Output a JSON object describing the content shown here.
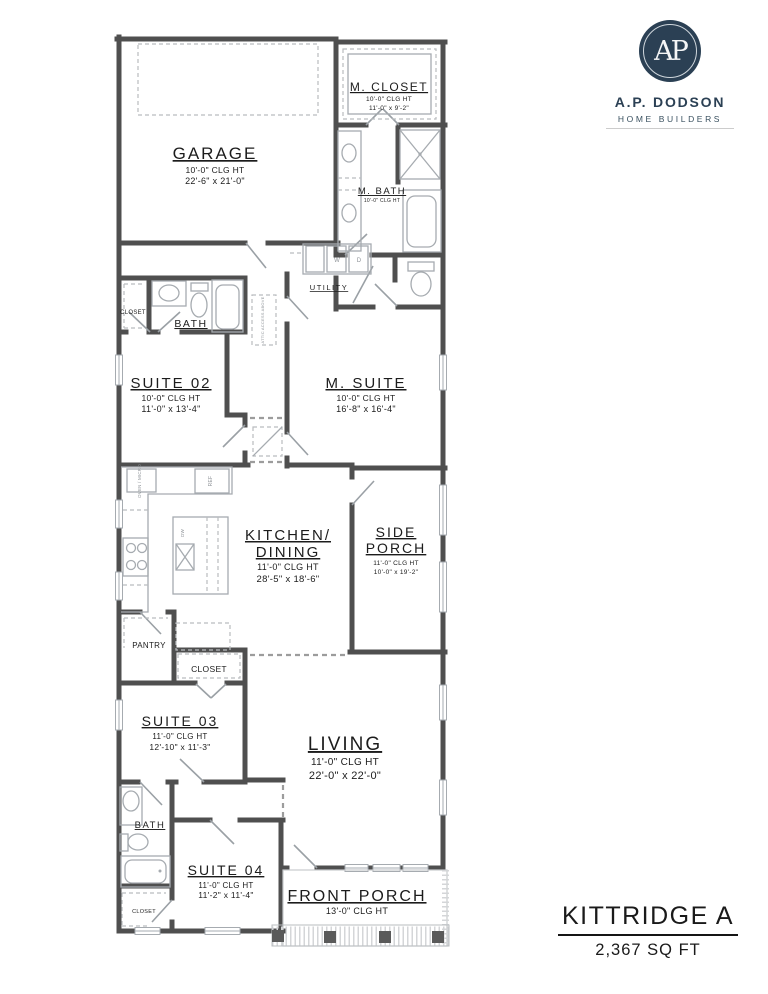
{
  "brand": {
    "monogram": "AP",
    "name": "A.P. DODSON",
    "tagline": "HOME BUILDERS",
    "navy": "#2b4054"
  },
  "title_block": {
    "plan_name": "KITTRIDGE A",
    "area": "2,367 SQ FT"
  },
  "rooms": {
    "garage": {
      "label": "GARAGE",
      "clg": "10'-0\" CLG HT",
      "dims": "22'-6\" x 21'-0\""
    },
    "m_closet": {
      "label": "M. CLOSET",
      "clg": "10'-0\" CLG HT",
      "dims": "11'-0\" x 9'-2\""
    },
    "m_bath": {
      "label": "M. BATH",
      "clg": "10'-0\" CLG HT"
    },
    "utility": {
      "label": "UTILITY"
    },
    "bath2": {
      "label": "BATH"
    },
    "closet2": {
      "label": "CLOSET"
    },
    "suite02": {
      "label": "SUITE 02",
      "clg": "10'-0\" CLG HT",
      "dims": "11'-0\" x 13'-4\""
    },
    "m_suite": {
      "label": "M. SUITE",
      "clg": "10'-0\" CLG HT",
      "dims": "16'-8\" x 16'-4\""
    },
    "kitchen": {
      "label": "KITCHEN/",
      "label2": "DINING",
      "clg": "11'-0\" CLG HT",
      "dims": "28'-5\" x 18'-6\""
    },
    "side_porch": {
      "label": "SIDE",
      "label2": "PORCH",
      "clg": "11'-0\" CLG HT",
      "dims": "10'-0\" x 19'-2\""
    },
    "pantry": {
      "label": "PANTRY"
    },
    "hall_closet": {
      "label": "CLOSET"
    },
    "suite03": {
      "label": "SUITE 03",
      "clg": "11'-0\" CLG HT",
      "dims": "12'-10\" x 11'-3\""
    },
    "living": {
      "label": "LIVING",
      "clg": "11'-0\" CLG HT",
      "dims": "22'-0\" x 22'-0\""
    },
    "bath4": {
      "label": "BATH"
    },
    "suite04": {
      "label": "SUITE 04",
      "clg": "11'-0\" CLG HT",
      "dims": "11'-2\" x 11'-4\""
    },
    "closet4": {
      "label": "CLOSET"
    },
    "front_porch": {
      "label": "FRONT PORCH",
      "clg": "13'-0\" CLG HT"
    }
  },
  "annotations": {
    "washer": "W",
    "dryer": "D",
    "ref": "REF",
    "dw": "DW",
    "oven_micro": "OVEN / MICRO",
    "attic_note": "ATTIC ACCESS ABOVE"
  }
}
